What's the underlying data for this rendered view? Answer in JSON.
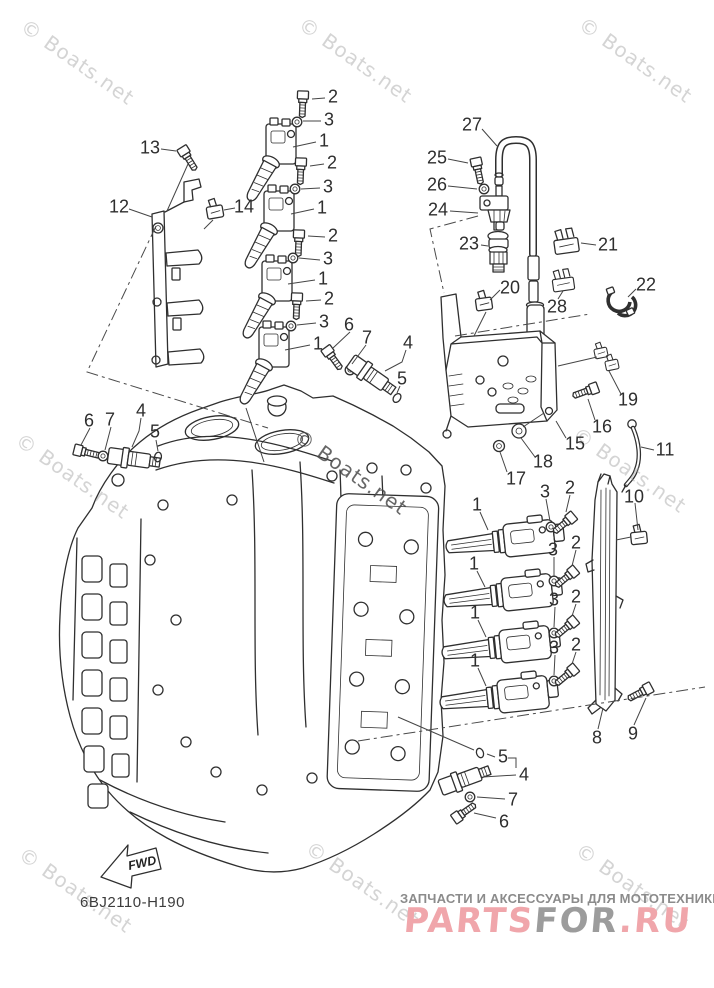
{
  "diagram": {
    "part_code": "6BJ2110-H190",
    "fwd_label": "FWD",
    "line_color": "#2f2f2f",
    "callouts": [
      {
        "n": "2",
        "x": 333,
        "y": 97
      },
      {
        "n": "3",
        "x": 329,
        "y": 120
      },
      {
        "n": "1",
        "x": 324,
        "y": 141
      },
      {
        "n": "2",
        "x": 332,
        "y": 163
      },
      {
        "n": "3",
        "x": 328,
        "y": 187
      },
      {
        "n": "1",
        "x": 322,
        "y": 208
      },
      {
        "n": "2",
        "x": 333,
        "y": 236
      },
      {
        "n": "3",
        "x": 328,
        "y": 259
      },
      {
        "n": "1",
        "x": 323,
        "y": 279
      },
      {
        "n": "2",
        "x": 329,
        "y": 299
      },
      {
        "n": "3",
        "x": 324,
        "y": 322
      },
      {
        "n": "1",
        "x": 318,
        "y": 344
      },
      {
        "n": "13",
        "x": 150,
        "y": 148
      },
      {
        "n": "12",
        "x": 119,
        "y": 207
      },
      {
        "n": "14",
        "x": 244,
        "y": 207
      },
      {
        "n": "27",
        "x": 472,
        "y": 125
      },
      {
        "n": "25",
        "x": 437,
        "y": 158
      },
      {
        "n": "26",
        "x": 437,
        "y": 185
      },
      {
        "n": "24",
        "x": 438,
        "y": 210
      },
      {
        "n": "23",
        "x": 469,
        "y": 244
      },
      {
        "n": "21",
        "x": 608,
        "y": 245
      },
      {
        "n": "20",
        "x": 510,
        "y": 288
      },
      {
        "n": "28",
        "x": 557,
        "y": 307
      },
      {
        "n": "22",
        "x": 646,
        "y": 285
      },
      {
        "n": "19",
        "x": 628,
        "y": 400
      },
      {
        "n": "16",
        "x": 602,
        "y": 427
      },
      {
        "n": "15",
        "x": 575,
        "y": 444
      },
      {
        "n": "18",
        "x": 543,
        "y": 462
      },
      {
        "n": "17",
        "x": 516,
        "y": 479
      },
      {
        "n": "11",
        "x": 665,
        "y": 450
      },
      {
        "n": "10",
        "x": 634,
        "y": 497
      },
      {
        "n": "6",
        "x": 349,
        "y": 325
      },
      {
        "n": "7",
        "x": 367,
        "y": 338
      },
      {
        "n": "4",
        "x": 408,
        "y": 343
      },
      {
        "n": "5",
        "x": 402,
        "y": 379
      },
      {
        "n": "6",
        "x": 89,
        "y": 421
      },
      {
        "n": "7",
        "x": 110,
        "y": 420
      },
      {
        "n": "4",
        "x": 141,
        "y": 411
      },
      {
        "n": "5",
        "x": 155,
        "y": 432
      },
      {
        "n": "1",
        "x": 477,
        "y": 505
      },
      {
        "n": "3",
        "x": 545,
        "y": 492
      },
      {
        "n": "2",
        "x": 570,
        "y": 488
      },
      {
        "n": "1",
        "x": 474,
        "y": 564
      },
      {
        "n": "3",
        "x": 553,
        "y": 550
      },
      {
        "n": "2",
        "x": 576,
        "y": 543
      },
      {
        "n": "1",
        "x": 475,
        "y": 613
      },
      {
        "n": "3",
        "x": 554,
        "y": 600
      },
      {
        "n": "2",
        "x": 576,
        "y": 597
      },
      {
        "n": "1",
        "x": 475,
        "y": 661
      },
      {
        "n": "3",
        "x": 554,
        "y": 648
      },
      {
        "n": "2",
        "x": 576,
        "y": 645
      },
      {
        "n": "8",
        "x": 597,
        "y": 738
      },
      {
        "n": "9",
        "x": 633,
        "y": 734
      },
      {
        "n": "5",
        "x": 503,
        "y": 757
      },
      {
        "n": "4",
        "x": 524,
        "y": 775
      },
      {
        "n": "7",
        "x": 513,
        "y": 800
      },
      {
        "n": "6",
        "x": 504,
        "y": 822
      }
    ]
  },
  "watermark": {
    "text": "© Boats.net",
    "color_light": "rgba(160,160,160,0.45)",
    "color_dark": "rgba(75,75,75,0.85)",
    "positions": [
      {
        "x": 30,
        "y": 14
      },
      {
        "x": 308,
        "y": 12
      },
      {
        "x": 588,
        "y": 12
      },
      {
        "x": 25,
        "y": 428
      },
      {
        "x": 303,
        "y": 424,
        "dark": true
      },
      {
        "x": 582,
        "y": 422
      },
      {
        "x": 28,
        "y": 842
      },
      {
        "x": 315,
        "y": 836
      },
      {
        "x": 585,
        "y": 838
      }
    ]
  },
  "footer": {
    "tagline": "ЗАПЧАСТИ И АКСЕССУАРЫ ДЛЯ МОТОТЕХНИКИ",
    "tagline_color": "#8b8b8b",
    "logo": {
      "parts_text": "PARTS",
      "for_text": "FOR",
      "ru_text": ".RU",
      "pink_color": "#f0a6ab",
      "grey_color": "#9c9c9c"
    }
  }
}
